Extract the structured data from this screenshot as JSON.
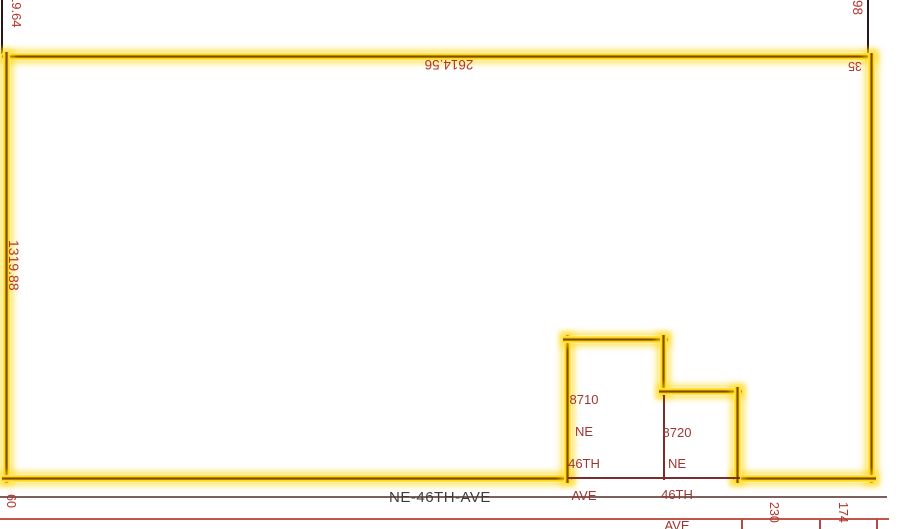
{
  "map": {
    "street": {
      "name": "NE-46TH-AVE",
      "right_of_way_width": "60"
    },
    "parcels": [
      {
        "address_lines": [
          "8710",
          "NE",
          "46TH",
          "AVE"
        ]
      },
      {
        "address_lines": [
          "8720",
          "NE",
          "46TH",
          "AVE"
        ]
      }
    ],
    "dimensions": {
      "west_upper_partial": "19.64",
      "west": "1319.88",
      "north": "2614.56",
      "east_upper_partial": "98",
      "northeast_inner": "35",
      "south_frontage_1": "230",
      "south_frontage_2": "174"
    },
    "colors": {
      "selection_highlight": "#ffd400",
      "boundary_core": "#7a4300",
      "dimension_text": "#b5352b",
      "address_text": "#9c3632",
      "lot_line": "#7a2e2e",
      "section_line": "#2a1616",
      "street_centerline": "#7d5f5c",
      "street_edge_line": "#c2564c",
      "street_text": "#3d3d3d"
    }
  }
}
